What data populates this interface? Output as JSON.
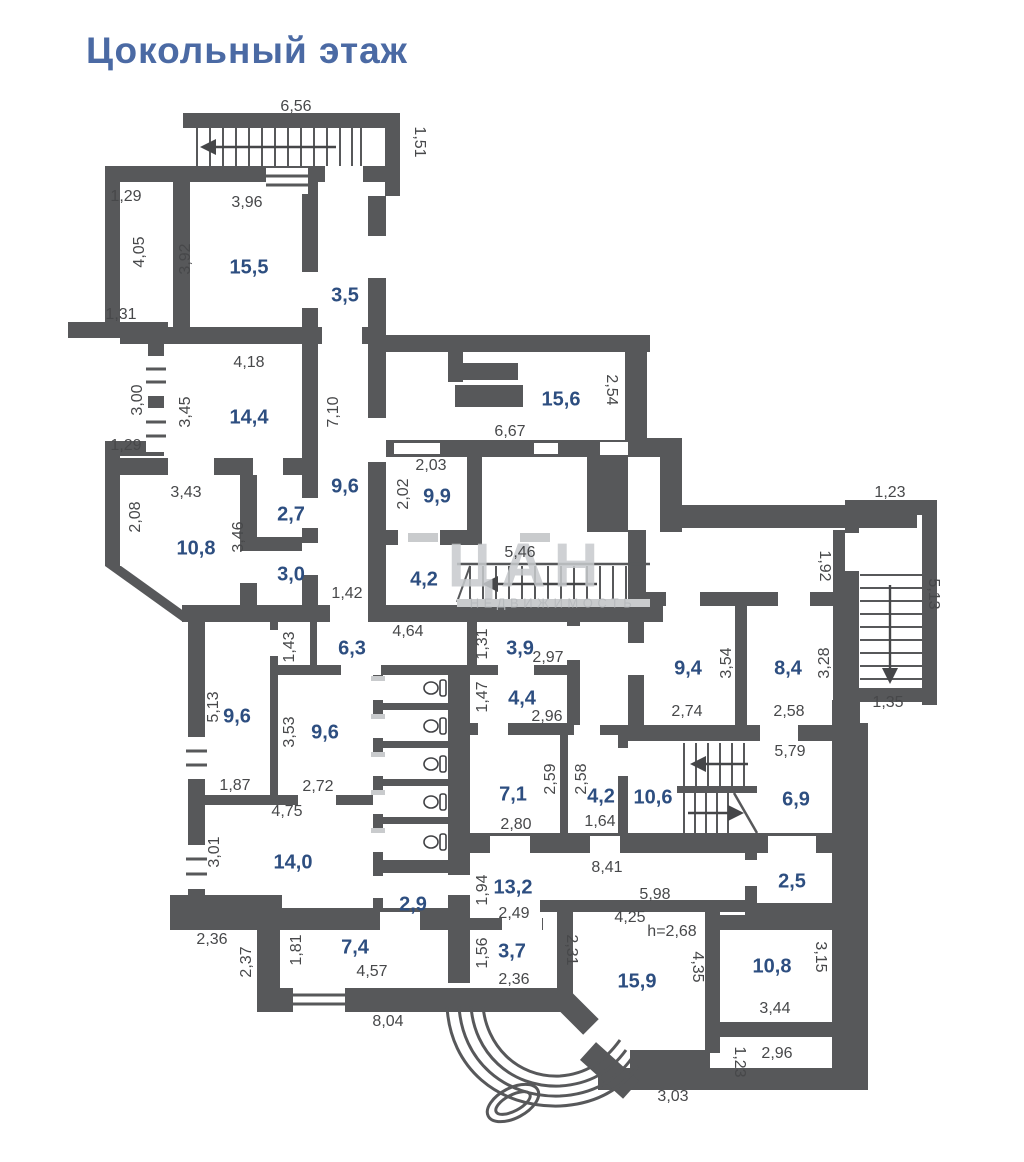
{
  "title": "Цокольный этаж",
  "watermark": {
    "logo": "ЦАН",
    "subtitle": "НЕДВИЖИМОСТЬ"
  },
  "colors": {
    "wall": "#57585a",
    "title_text": "#4b6aa4",
    "room_area_text": "#2d4e80",
    "dimension_text": "#47484a",
    "watermark": "#c7cacd",
    "background": "#ffffff"
  },
  "plan": {
    "rooms": [
      {
        "t": "15,5",
        "x": 249,
        "y": 268
      },
      {
        "t": "3,5",
        "x": 345,
        "y": 296
      },
      {
        "t": "14,4",
        "x": 249,
        "y": 418
      },
      {
        "t": "15,6",
        "x": 561,
        "y": 400
      },
      {
        "t": "9,9",
        "x": 437,
        "y": 497
      },
      {
        "t": "9,6",
        "x": 345,
        "y": 487
      },
      {
        "t": "2,7",
        "x": 291,
        "y": 515
      },
      {
        "t": "10,8",
        "x": 196,
        "y": 549
      },
      {
        "t": "3,0",
        "x": 291,
        "y": 575
      },
      {
        "t": "4,2",
        "x": 424,
        "y": 580
      },
      {
        "t": "6,3",
        "x": 352,
        "y": 649
      },
      {
        "t": "3,9",
        "x": 520,
        "y": 649
      },
      {
        "t": "9,4",
        "x": 688,
        "y": 669
      },
      {
        "t": "8,4",
        "x": 788,
        "y": 669
      },
      {
        "t": "9,6",
        "x": 237,
        "y": 717
      },
      {
        "t": "9,6",
        "x": 325,
        "y": 733
      },
      {
        "t": "4,4",
        "x": 522,
        "y": 699
      },
      {
        "t": "7,1",
        "x": 513,
        "y": 795
      },
      {
        "t": "4,2",
        "x": 601,
        "y": 797
      },
      {
        "t": "10,6",
        "x": 653,
        "y": 798
      },
      {
        "t": "6,9",
        "x": 796,
        "y": 800
      },
      {
        "t": "14,0",
        "x": 293,
        "y": 863
      },
      {
        "t": "2,9",
        "x": 413,
        "y": 905
      },
      {
        "t": "13,2",
        "x": 513,
        "y": 888
      },
      {
        "t": "2,5",
        "x": 792,
        "y": 882
      },
      {
        "t": "7,4",
        "x": 355,
        "y": 948
      },
      {
        "t": "3,7",
        "x": 512,
        "y": 952
      },
      {
        "t": "15,9",
        "x": 637,
        "y": 982
      },
      {
        "t": "10,8",
        "x": 772,
        "y": 967
      }
    ],
    "dimensions": [
      {
        "t": "6,56",
        "x": 296,
        "y": 107
      },
      {
        "t": "1,51",
        "x": 419,
        "y": 142,
        "r": 90
      },
      {
        "t": "1,29",
        "x": 126,
        "y": 197
      },
      {
        "t": "3,96",
        "x": 247,
        "y": 203
      },
      {
        "t": "4,05",
        "x": 140,
        "y": 252,
        "r": -90
      },
      {
        "t": "3,92",
        "x": 186,
        "y": 259,
        "r": -90
      },
      {
        "t": "1,31",
        "x": 121,
        "y": 315
      },
      {
        "t": "4,18",
        "x": 249,
        "y": 363
      },
      {
        "t": "3,00",
        "x": 138,
        "y": 400,
        "r": -90
      },
      {
        "t": "3,45",
        "x": 186,
        "y": 412,
        "r": -90
      },
      {
        "t": "7,10",
        "x": 334,
        "y": 412,
        "r": -90
      },
      {
        "t": "1,29",
        "x": 126,
        "y": 446
      },
      {
        "t": "2,54",
        "x": 611,
        "y": 390,
        "r": 90
      },
      {
        "t": "6,67",
        "x": 510,
        "y": 432
      },
      {
        "t": "2,03",
        "x": 431,
        "y": 466
      },
      {
        "t": "2,02",
        "x": 404,
        "y": 494,
        "r": -90
      },
      {
        "t": "3,43",
        "x": 186,
        "y": 493
      },
      {
        "t": "2,08",
        "x": 136,
        "y": 517,
        "r": -90
      },
      {
        "t": "3,46",
        "x": 239,
        "y": 537,
        "r": -90
      },
      {
        "t": "1,42",
        "x": 347,
        "y": 594
      },
      {
        "t": "5,46",
        "x": 520,
        "y": 553
      },
      {
        "t": "1,23",
        "x": 890,
        "y": 493
      },
      {
        "t": "1,92",
        "x": 824,
        "y": 566,
        "r": 90
      },
      {
        "t": "5,13",
        "x": 933,
        "y": 594,
        "r": 90
      },
      {
        "t": "1,35",
        "x": 888,
        "y": 703
      },
      {
        "t": "4,64",
        "x": 408,
        "y": 632
      },
      {
        "t": "1,43",
        "x": 290,
        "y": 647,
        "r": -90
      },
      {
        "t": "1,31",
        "x": 483,
        "y": 644,
        "r": -90
      },
      {
        "t": "2,97",
        "x": 548,
        "y": 658
      },
      {
        "t": "3,54",
        "x": 727,
        "y": 663,
        "r": -90
      },
      {
        "t": "3,28",
        "x": 825,
        "y": 663,
        "r": -90
      },
      {
        "t": "5,13",
        "x": 214,
        "y": 707,
        "r": -90
      },
      {
        "t": "1,47",
        "x": 483,
        "y": 697,
        "r": -90
      },
      {
        "t": "2,96",
        "x": 547,
        "y": 717
      },
      {
        "t": "2,74",
        "x": 687,
        "y": 712
      },
      {
        "t": "2,58",
        "x": 789,
        "y": 712
      },
      {
        "t": "3,53",
        "x": 290,
        "y": 732,
        "r": -90
      },
      {
        "t": "2,72",
        "x": 318,
        "y": 787
      },
      {
        "t": "1,87",
        "x": 235,
        "y": 786
      },
      {
        "t": "2,59",
        "x": 551,
        "y": 779,
        "r": -90
      },
      {
        "t": "2,58",
        "x": 582,
        "y": 779,
        "r": -90
      },
      {
        "t": "1,64",
        "x": 600,
        "y": 822
      },
      {
        "t": "5,79",
        "x": 790,
        "y": 752
      },
      {
        "t": "2,80",
        "x": 516,
        "y": 825
      },
      {
        "t": "4,75",
        "x": 287,
        "y": 812
      },
      {
        "t": "3,01",
        "x": 215,
        "y": 852,
        "r": -90
      },
      {
        "t": "8,41",
        "x": 607,
        "y": 868
      },
      {
        "t": "1,94",
        "x": 483,
        "y": 890,
        "r": -90
      },
      {
        "t": "5,98",
        "x": 655,
        "y": 895
      },
      {
        "t": "2,49",
        "x": 514,
        "y": 914
      },
      {
        "t": "4,25",
        "x": 630,
        "y": 918
      },
      {
        "t": "h=2,68",
        "x": 672,
        "y": 932
      },
      {
        "t": "1,56",
        "x": 483,
        "y": 953,
        "r": -90
      },
      {
        "t": "2,31",
        "x": 571,
        "y": 950,
        "r": 90
      },
      {
        "t": "2,36",
        "x": 212,
        "y": 940
      },
      {
        "t": "2,37",
        "x": 247,
        "y": 962,
        "r": -90
      },
      {
        "t": "1,81",
        "x": 297,
        "y": 950,
        "r": -90
      },
      {
        "t": "4,57",
        "x": 372,
        "y": 972
      },
      {
        "t": "2,36",
        "x": 514,
        "y": 980
      },
      {
        "t": "4,35",
        "x": 697,
        "y": 967,
        "r": 90
      },
      {
        "t": "3,15",
        "x": 820,
        "y": 957,
        "r": 90
      },
      {
        "t": "3,44",
        "x": 775,
        "y": 1009
      },
      {
        "t": "8,04",
        "x": 388,
        "y": 1022
      },
      {
        "t": "2,96",
        "x": 777,
        "y": 1054
      },
      {
        "t": "1,23",
        "x": 739,
        "y": 1062,
        "r": 90
      },
      {
        "t": "3,03",
        "x": 673,
        "y": 1097
      }
    ]
  }
}
